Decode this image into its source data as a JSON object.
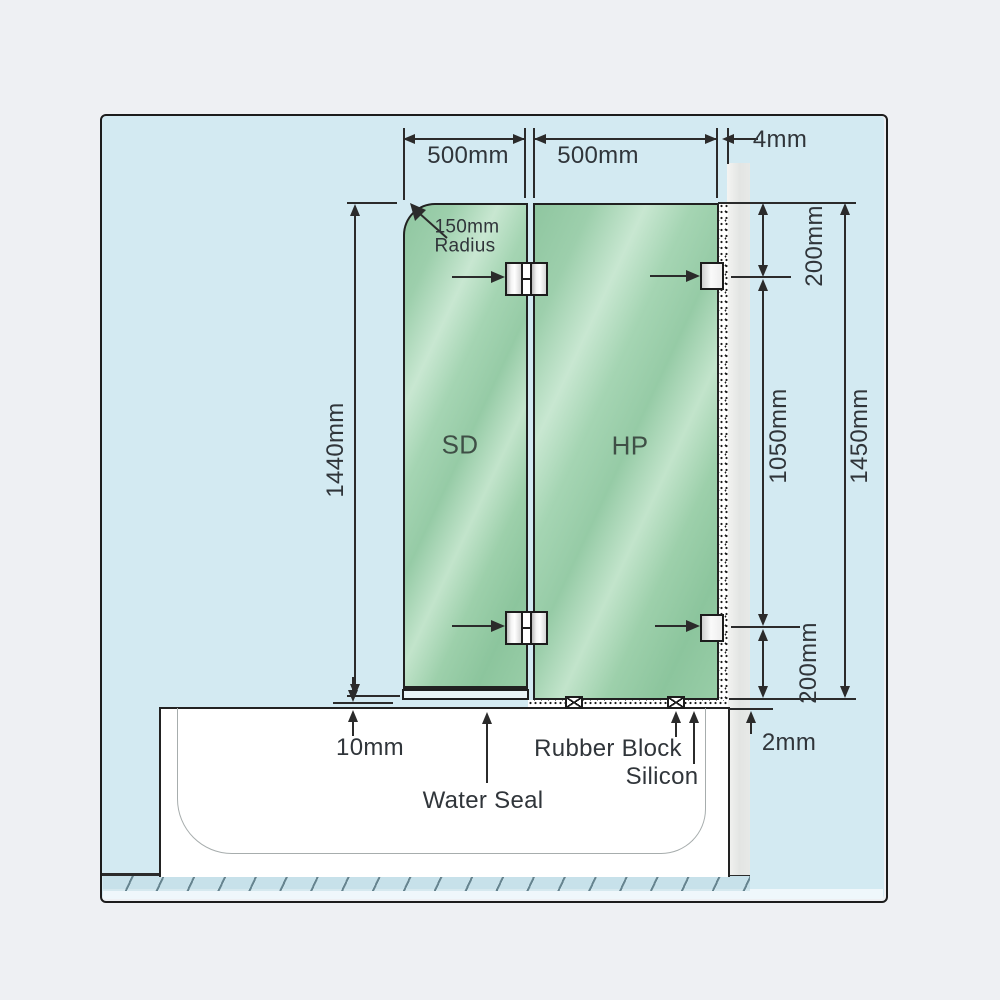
{
  "dimensions": {
    "sd_width": "500mm",
    "hp_width": "500mm",
    "wall_gap": "4mm",
    "sd_height": "1440mm",
    "corner_radius_value": "150mm",
    "corner_radius_word": "Radius",
    "top_bracket_offset": "200mm",
    "bracket_span": "1050mm",
    "hp_height": "1450mm",
    "bottom_bracket_offset": "200mm",
    "floor_gap": "10mm",
    "tub_gap": "2mm"
  },
  "panels": {
    "door_label": "SD",
    "fixed_label": "HP"
  },
  "annotations": {
    "water_seal": "Water Seal",
    "rubber_block": "Rubber Block",
    "silicon": "Silicon"
  },
  "colors": {
    "background": "#eef0f3",
    "canvas": "#d3eaf2",
    "glass": "#9ed0ac",
    "glass_highlight": "#c8e7d1",
    "wall": "#e4e6e4",
    "tub": "#ffffff",
    "line": "#2b2b2b"
  }
}
